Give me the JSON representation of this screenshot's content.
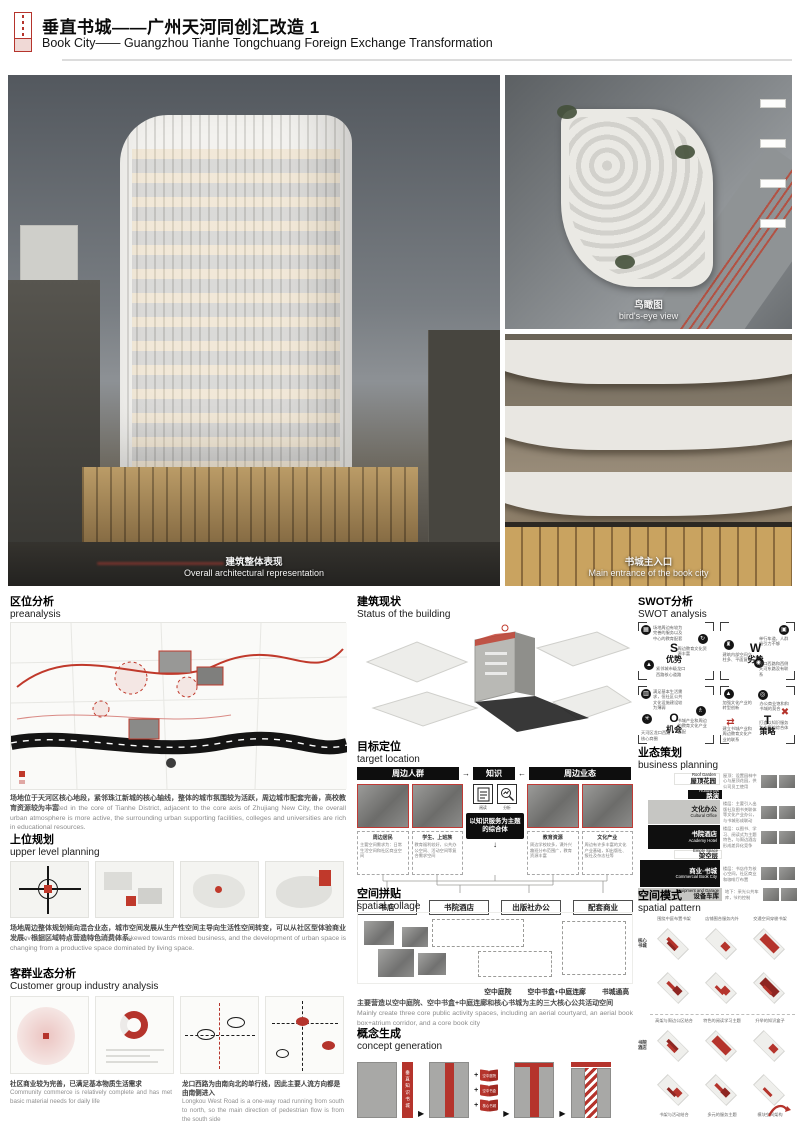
{
  "glyphs": {
    "arrow": "▶",
    "plus": "+",
    "down_arrow": "↓",
    "right_arrow": "→",
    "left_arrow": "←"
  },
  "header": {
    "title_cn": "垂直书城——广州天河同创汇改造 1",
    "title_en": "Book City—— Guangzhou Tianhe Tongchuang Foreign Exchange Transformation"
  },
  "renders": {
    "main": {
      "cn": "建筑整体表现",
      "en": "Overall architectural representation"
    },
    "birdseye": {
      "cn": "鸟瞰图",
      "en": "bird's-eye view"
    },
    "entrance": {
      "cn": "书城主入口",
      "en": "Main entrance of the book city"
    }
  },
  "sections": {
    "pre": {
      "cn": "区位分析",
      "en": "preanalysis",
      "text_cn": "场地位于天河区核心地段，紧邻珠江新城的核心轴线，整体的城市氛围较为活跃，周边城市配套完善，高校教育资源较为丰富",
      "text_en": "The site is located in the core of Tianhe District, adjacent to the core axis of Zhujiang New City, the overall urban atmosphere is more active, the surrounding urban supporting facilities, colleges and universities are rich in educational resources."
    },
    "upper": {
      "cn": "上位规划",
      "en": "upper level planning",
      "text_cn": "场地周边整体规划倾向混合业态，城市空间发展从生产性空间主导向生活性空间转变，可以从社区型体验商业发展、根据区域特点营造特色消费体系。",
      "text_en": "The overall planning around the site is skewed towards mixed business, and the development of urban space is changing from a productive space dominated by living space."
    },
    "customer": {
      "cn": "客群业态分析",
      "en": "Customer group industry analysis",
      "note1_cn": "社区商业较为完善，已满足基本物质生活需求",
      "note1_en": "Community commerce is relatively complete and has met basic material needs for daily life",
      "note2_cn": "龙口西路为由南向北的单行线，因此主要人流方向都是由南侧进入",
      "note2_en": "Longkou West Road is a one-way road running from south to north, so the main direction of pedestrian flow is from the south side"
    },
    "status": {
      "cn": "建筑现状",
      "en": "Status of the building"
    },
    "target": {
      "cn": "目标定位",
      "en": "target location",
      "bar_left": "周边人群",
      "bar_mid": "知识",
      "bar_right": "周边业态",
      "icon1": "阅读",
      "icon2": "分析",
      "core": "以知识服务为主题的综合体",
      "groups": [
        {
          "t": "周边居民",
          "d": "主要空间需求为：日常生活空间和社区商业空间"
        },
        {
          "t": "学生、上班族",
          "d": "教育福利较好，公共办公空间、活动空间等复合需求空间"
        },
        {
          "t": "教育资源",
          "d": "周边学校较多，课外兴趣班分布范围广，教育资源丰富"
        },
        {
          "t": "文化产业",
          "d": "周边有许多丰富的文化产业基础，如出版社、报社及杂志社等"
        }
      ],
      "outputs": [
        "书店",
        "书院酒店",
        "出版社办公",
        "配套商业"
      ]
    },
    "collage": {
      "cn": "空间拼贴",
      "en": "spatial collage",
      "labels": [
        "空中庭院",
        "空中书盒+中庭连廊",
        "书城通高"
      ],
      "text_cn": "主要营造以空中庭院、空中书盒+中庭连廊和核心书城为主的三大核心公共活动空间",
      "text_en": "Mainly create three core public activity spaces, including an aerial courtyard, an aerial book box+atrium corridor, and a core book city"
    },
    "concept": {
      "cn": "概念生成",
      "en": "concept generation",
      "strip": "垂直知识书城",
      "books": [
        "空中庭院",
        "空中书盒",
        "核心书城"
      ]
    },
    "swot": {
      "cn": "SWOT分析",
      "en": "SWOT analysis",
      "quads": [
        {
          "letter": "S",
          "word": "优势",
          "n1": "场地周边有较为完善的服务以及中心的教育配套",
          "n2": "周边教育文化资源丰富",
          "n3": "紧邻城市级龙口西路核心道路"
        },
        {
          "letter": "W",
          "word": "劣势",
          "n1": "单行车道，人群吸引力不够",
          "n2": "建筑内部空间立柱多、平面复杂",
          "n3": "龙口西路和西侧天河东路没有联系"
        },
        {
          "letter": "O",
          "word": "机会",
          "n1": "满足基本生活需求，但社区公共文化设施建设较为薄弱",
          "n2": "书城产业和周边的教育文化产业匹配",
          "n3": "天河区龙口西路核心商圈"
        },
        {
          "letter": "T",
          "word": "策略",
          "n1": "办公商业饱和和书城的契合",
          "n2": "加强文化产业的转型创新",
          "n3": "打造以知识服务为主题的综合体",
          "n4": "建立书城产业和周边教育文化产业的联系"
        }
      ]
    },
    "business": {
      "cn": "业态策划",
      "en": "business planning",
      "rows": [
        {
          "en": "Roof Garden",
          "cn": "屋顶花园",
          "d": "屋顶：设置园林中心与屋顶花园，供公司员工使用"
        },
        {
          "en": "Roadshow",
          "cn": "路演",
          "d": ""
        },
        {
          "en": "Cultural Office",
          "cn": "文化办公",
          "d": "楼层：主要引入出版社及图书关联体等文化产业办公，与书城形成联动"
        },
        {
          "en": "Academy Hotel",
          "cn": "书院酒店",
          "d": "楼层：以图书、学习、阅读式为主题特色，与周边酒店形成差异化竞争"
        },
        {
          "en": "Empty Space",
          "cn": "架空层",
          "d": ""
        },
        {
          "en": "Commercial Book City",
          "cn": "商业·书城",
          "d": "楼层：书店作为核心空间，社区商业和咖啡厅布置"
        },
        {
          "en": "Equipment and Garage",
          "cn": "设备车库",
          "d": "地下：采光公共车库，节约控制"
        }
      ]
    },
    "pattern": {
      "cn": "空间模式",
      "en": "spatial pattern",
      "row1": "核心书城",
      "row2": "书院酒店",
      "cap_top": [
        "围绕中庭布置书架",
        "店铺围合服务内外",
        "交通空间穿梭书架"
      ],
      "cap_mid": [
        "高架与周边公区结合",
        "特色的阅读学习主题",
        "升举的知识盒子"
      ],
      "cap_bot": [
        "书架与活动结合",
        "多元的服务主题",
        "模块空间架构"
      ]
    }
  }
}
